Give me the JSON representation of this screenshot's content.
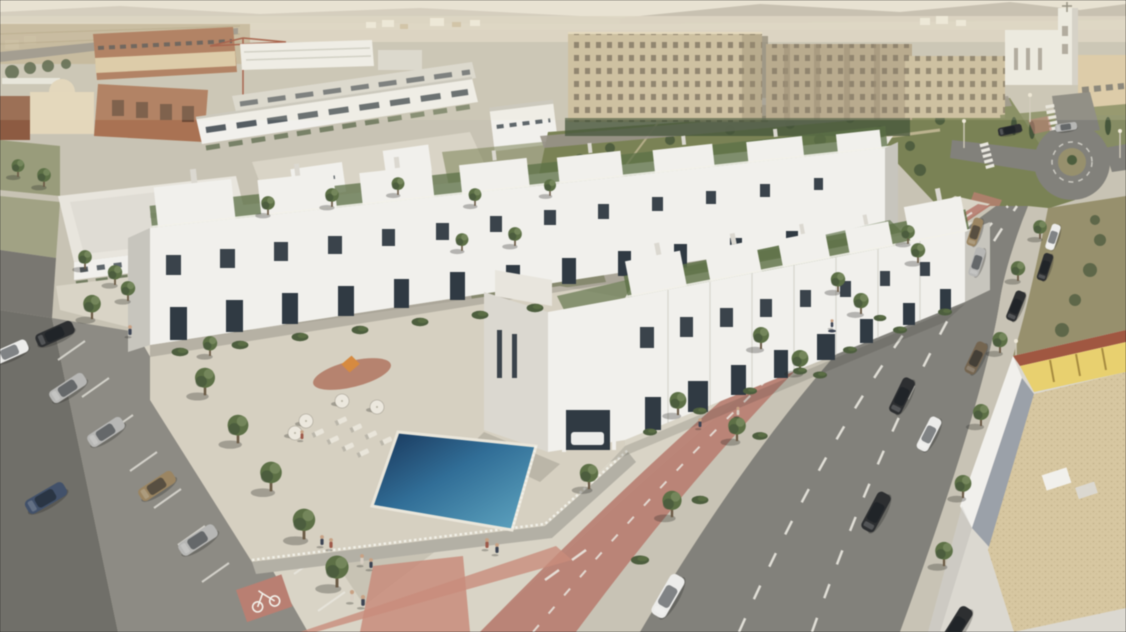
{
  "title": "Aerial render of a white townhouse residential development",
  "scene": {
    "type": "3D architectural visualization, aerial oblique view",
    "lighting": "warm low sun from upper right, hazy horizon",
    "areas": {
      "foreground": "two long rows of white three-storey townhouses with roof terraces and chimneys",
      "courtyard": "raised communal deck with swimming pool, sun loungers, parasols and a small playground",
      "left": "surface parking lot with angled stalls, parked cars and young trees",
      "bottom": "pedestrian plaza with salmon tile bands, a marked cycle path and people strolling",
      "right": "wide avenue with dashed lanes, red cycle lane, parked cars, street trees and a roundabout",
      "background": "beige apartment blocks, a white church tower, brick buildings under construction with a crane, hazy mountains and distant city"
    },
    "counts": {
      "townhouse_rows": 2,
      "pool": 1,
      "parasols": 4,
      "sun_loungers": 8,
      "parking_lot_cars": 7,
      "street_cars": 13,
      "people": 13,
      "street_trees": 28
    }
  },
  "colors": {
    "base": "#c8c3b3",
    "sky": "#e9e3d5",
    "mountain": "#b6ad9f",
    "haze": "#dcd4c2",
    "speck": "#efeadb",
    "speck_tan": "#cfc0a2",
    "field": "#bfb293",
    "road_top": "#989287",
    "park": "#7a8253",
    "scrub": "#97906c",
    "tree": "#5c7045",
    "tree_dark": "#46563a",
    "tree_light": "#7a8c5e",
    "hedge": "#4d5e3d",
    "trunk": "#6b5a44",
    "brick": "#ab7251",
    "brick_dark": "#8f5b41",
    "cream": "#ddc9a2",
    "dome": "#e4d7ba",
    "white": "#f1f0ec",
    "white_warm": "#e8e5dd",
    "white_shade": "#dbd8d0",
    "white_dark": "#c7c5bd",
    "window": "#3a434b",
    "opening": "#303a43",
    "apt": "#cbbb9a",
    "apt_dark": "#ad9b7c",
    "apt_window": "#6f6452",
    "church": "#eeece5",
    "road": "#82817b",
    "road_dark": "#706f69",
    "asphalt": "#8d8b84",
    "sidewalk": "#c8c3b4",
    "sidewalk_light": "#d9d4c5",
    "line_white": "#eae8e0",
    "bike_red": "#bb7f71",
    "plaza_red": "#ca8c7a",
    "deck": "#d6d0c0",
    "wall": "#b3b0a5",
    "fence": "#f2f1ea",
    "pool_dark": "#17345a",
    "pool_mid": "#2f6e99",
    "pool_light": "#5fa8c4",
    "gravel": "#d8c79f",
    "gravel_border": "#9ba1a9",
    "glow": "#e9d06b",
    "roof_edge": "#a2563f",
    "car_white": "#ececea",
    "car_silver": "#b7b7b5",
    "car_dark": "#2d2f31",
    "car_gold": "#9c8560",
    "car_blue": "#41516b",
    "car_brown": "#75654f",
    "umbrella": "#ece8de",
    "lounger": "#e9e5da",
    "person_dark": "#3c4454",
    "person_red": "#a05848",
    "person_light": "#d8cfc2",
    "crane": "#a04f38",
    "play_ground": "#b3765f",
    "slide_orange": "#d98a3c",
    "path_tan": "#cdbf9e",
    "shadow": "rgba(40,40,35,0.30)"
  }
}
